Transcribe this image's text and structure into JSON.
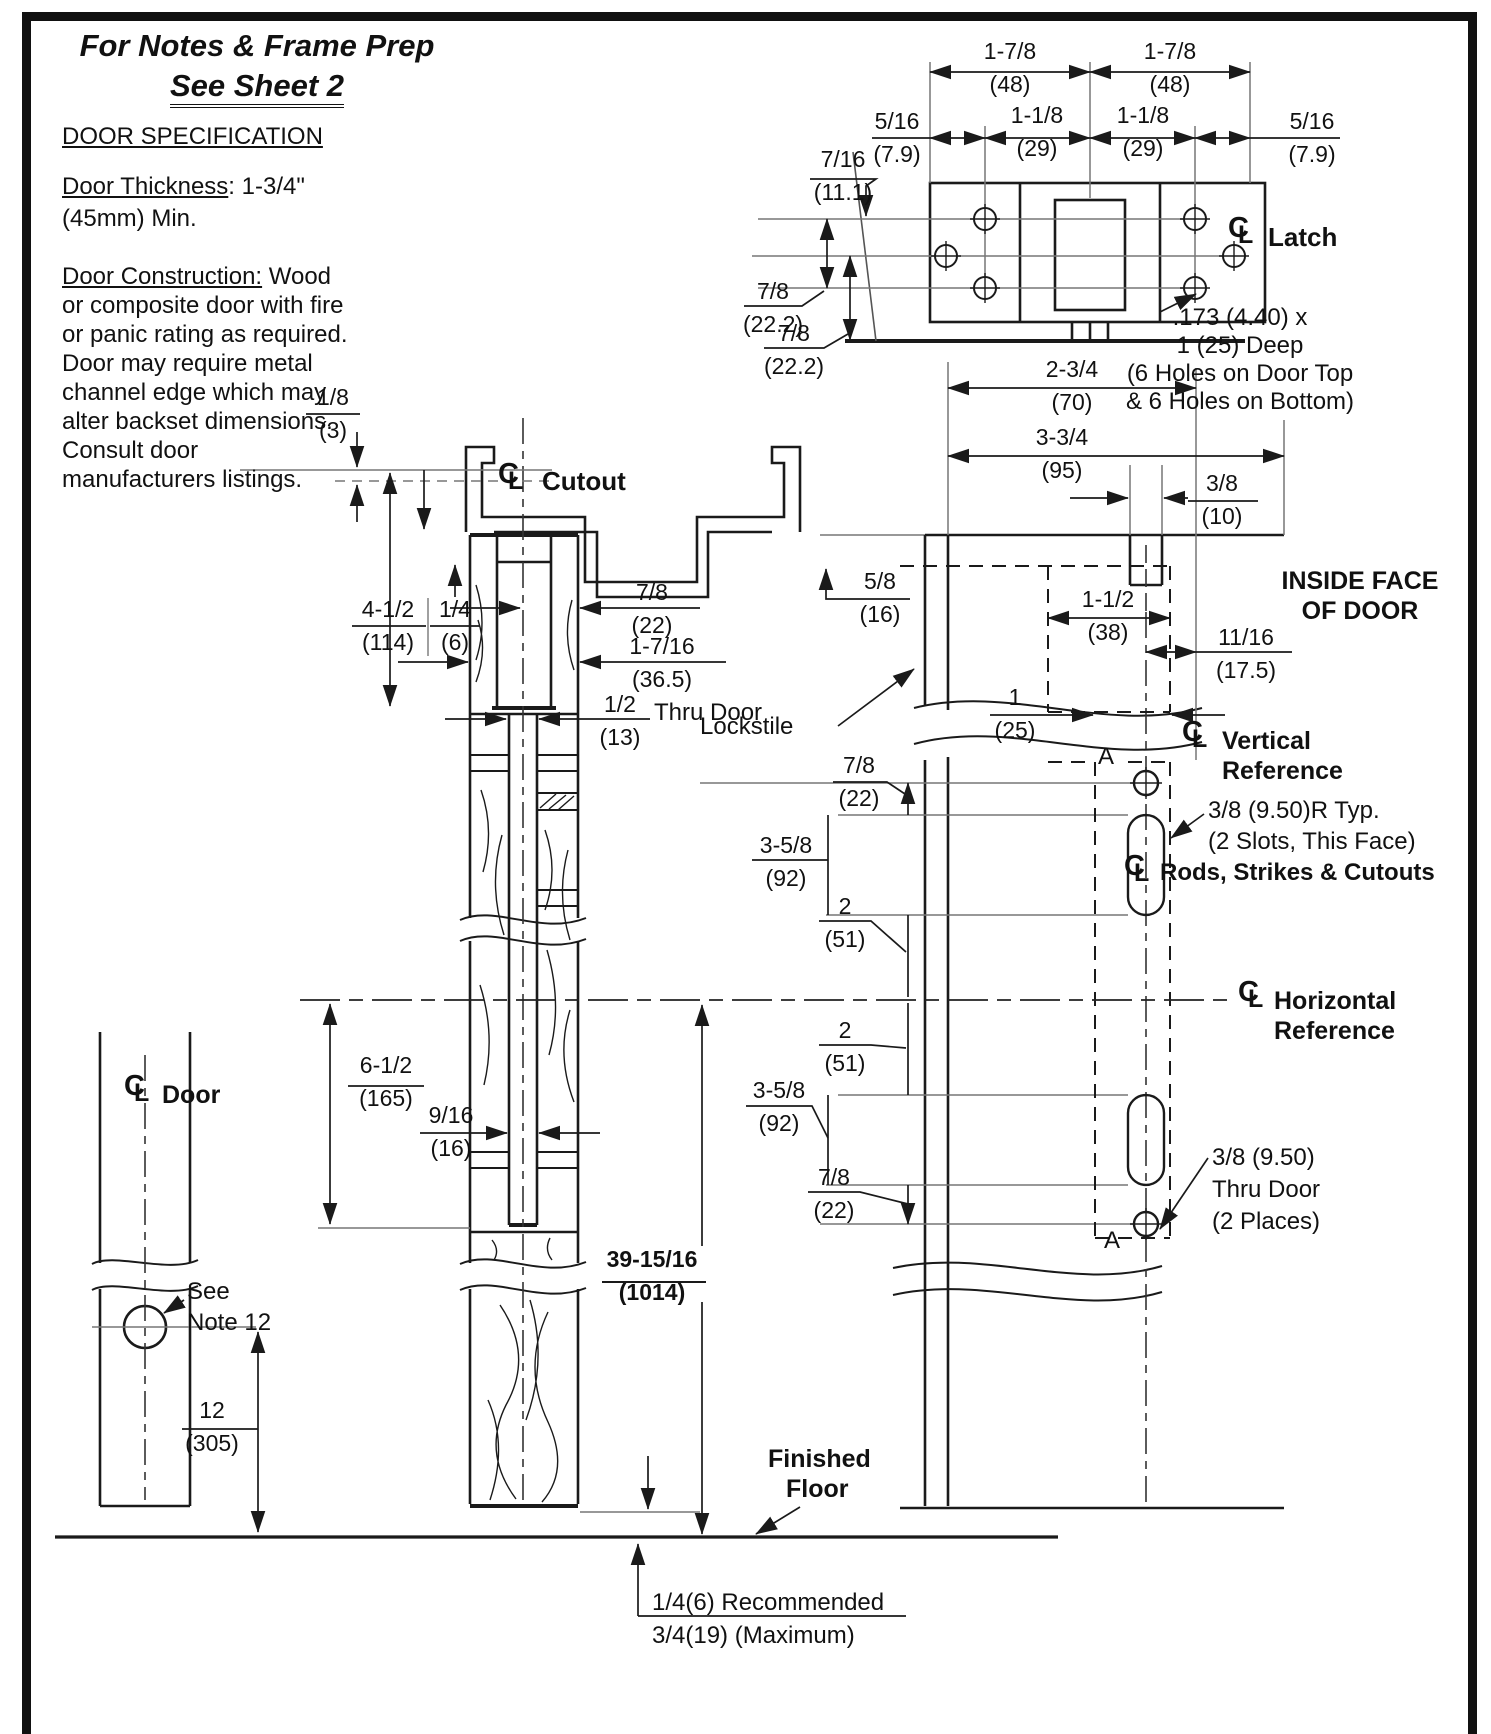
{
  "notes": {
    "title_line1": "For Notes & Frame Prep",
    "title_line2": "See Sheet 2"
  },
  "spec": {
    "heading": "DOOR SPECIFICATION",
    "thickness_label": "Door Thickness",
    "thickness_value": ": 1-3/4\"",
    "thickness_line2": "(45mm) Min.",
    "construction_label": "Door Construction:",
    "construction_first_suffix": " Wood",
    "construction_lines": [
      "or composite door with fire",
      "or panic rating as required.",
      "Door may require metal",
      "channel edge which may",
      "alter backset dimensions.",
      "Consult door",
      "manufacturers listings."
    ]
  },
  "labels": {
    "latch": "Latch",
    "cutout": "Cutout",
    "door": "Door",
    "lockstile": "Lockstile",
    "thru_door": "Thru Door",
    "inside_face_1": "INSIDE FACE",
    "inside_face_2": "OF DOOR",
    "vertical_ref_1": "Vertical",
    "vertical_ref_2": "Reference",
    "horizontal_ref_1": "Horizontal",
    "horizontal_ref_2": "Reference",
    "rods": "Rods, Strikes & Cutouts",
    "slot_note_1": "3/8 (9.50)R Typ.",
    "slot_note_2": "(2 Slots, This Face)",
    "hole_note_1": ".173 (4.40) x",
    "hole_note_2": "1 (25) Deep",
    "hole_note_3": "(6 Holes on Door Top",
    "hole_note_4": "& 6 Holes on Bottom)",
    "thru_note_1": "3/8 (9.50)",
    "thru_note_2": "Thru Door",
    "thru_note_3": "(2 Places)",
    "see_note_1": "See",
    "see_note_2": "Note 12",
    "finished_floor_1": "Finished",
    "finished_floor_2": "Floor",
    "floor_gap_1": "1/4(6) Recommended",
    "floor_gap_2": "3/4(19) (Maximum)",
    "marker_a_upper": "A",
    "marker_a_lower": "A"
  },
  "icons": {
    "centerline_c": "C",
    "centerline_l": "L"
  },
  "colors": {
    "line": "#1a1a1a",
    "thin": "#666666",
    "background": "#ffffff"
  },
  "dimensions": [
    {
      "v": "1-7/8",
      "mm": "(48)",
      "cx": 1010,
      "top": 38
    },
    {
      "v": "1-7/8",
      "mm": "(48)",
      "cx": 1170,
      "top": 38
    },
    {
      "v": "5/16",
      "mm": "(7.9)",
      "cx": 897,
      "top": 108
    },
    {
      "v": "1-1/8",
      "mm": "(29)",
      "cx": 1037,
      "top": 102
    },
    {
      "v": "1-1/8",
      "mm": "(29)",
      "cx": 1143,
      "top": 102
    },
    {
      "v": "5/16",
      "mm": "(7.9)",
      "cx": 1312,
      "top": 108
    },
    {
      "v": "7/16",
      "mm": "(11.1)",
      "cx": 843,
      "top": 146
    },
    {
      "v": "7/8",
      "mm": "(22.2)",
      "cx": 773,
      "top": 278
    },
    {
      "v": "7/8",
      "mm": "(22.2)",
      "cx": 794,
      "top": 320
    },
    {
      "v": "2-3/4",
      "mm": "(70)",
      "cx": 1072,
      "top": 356
    },
    {
      "v": "3-3/4",
      "mm": "(95)",
      "cx": 1062,
      "top": 424
    },
    {
      "v": "3/8",
      "mm": "(10)",
      "cx": 1222,
      "top": 470
    },
    {
      "v": "1/8",
      "mm": "(3)",
      "cx": 333,
      "top": 384
    },
    {
      "v": "5/8",
      "mm": "(16)",
      "cx": 880,
      "top": 568
    },
    {
      "v": "1-1/2",
      "mm": "(38)",
      "cx": 1108,
      "top": 586
    },
    {
      "v": "11/16",
      "mm": "(17.5)",
      "cx": 1246,
      "top": 624
    },
    {
      "v": "1",
      "mm": "(25)",
      "cx": 1015,
      "top": 684
    },
    {
      "v": "4-1/2",
      "mm": "(114)",
      "cx": 388,
      "top": 596
    },
    {
      "v": "1/4",
      "mm": "(6)",
      "cx": 455,
      "top": 596
    },
    {
      "v": "7/8",
      "mm": "(22)",
      "cx": 652,
      "top": 579
    },
    {
      "v": "1-7/16",
      "mm": "(36.5)",
      "cx": 662,
      "top": 633
    },
    {
      "v": "1/2",
      "mm": "(13)",
      "cx": 620,
      "top": 691
    },
    {
      "v": "7/8",
      "mm": "(22)",
      "cx": 859,
      "top": 752
    },
    {
      "v": "3-5/8",
      "mm": "(92)",
      "cx": 786,
      "top": 832
    },
    {
      "v": "2",
      "mm": "(51)",
      "cx": 845,
      "top": 893
    },
    {
      "v": "2",
      "mm": "(51)",
      "cx": 845,
      "top": 1017
    },
    {
      "v": "3-5/8",
      "mm": "(92)",
      "cx": 779,
      "top": 1077
    },
    {
      "v": "7/8",
      "mm": "(22)",
      "cx": 834,
      "top": 1164
    },
    {
      "v": "9/16",
      "mm": "(16)",
      "cx": 451,
      "top": 1102
    },
    {
      "v": "6-1/2",
      "mm": "(165)",
      "cx": 386,
      "top": 1052
    },
    {
      "v": "12",
      "mm": "(305)",
      "cx": 212,
      "top": 1397
    },
    {
      "v": "39-15/16",
      "mm": "(1014)",
      "cx": 652,
      "top": 1246,
      "bold": true
    }
  ]
}
